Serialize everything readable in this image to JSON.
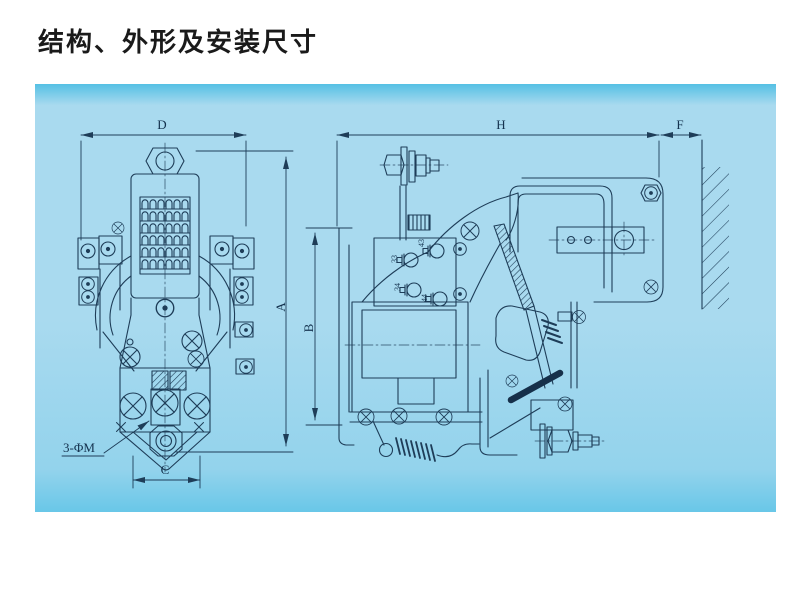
{
  "title": "结构、外形及安装尺寸",
  "colors": {
    "page_background": "#ffffff",
    "panel_top_band": "#55c0e4",
    "panel_main": "#a9daef",
    "panel_lower": "#93d3ec",
    "panel_bottom_band": "#69c7e8",
    "line_ink": "#1e3d58",
    "title_ink": "#1a1a1a"
  },
  "front_view": {
    "dim_width_label": "D",
    "dim_height_label": "A",
    "dim_terminal_pitch_label": "C",
    "mounting_hole_note": "3-ΦM"
  },
  "side_view": {
    "dim_height_label": "B",
    "dim_depth_label": "H",
    "dim_wall_clearance_label": "F",
    "aux_terminal_labels": [
      "43",
      "33",
      "34",
      "44"
    ]
  }
}
